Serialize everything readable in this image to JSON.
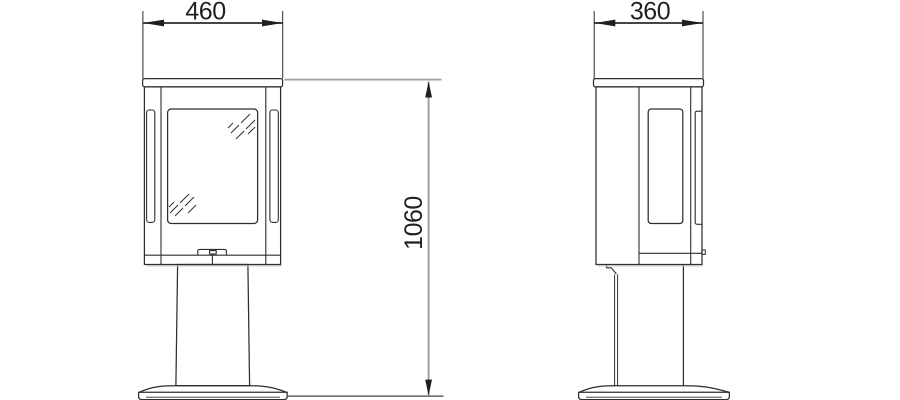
{
  "drawing": {
    "dimension_labels": {
      "front_width": "460",
      "side_width": "360",
      "height": "1060"
    },
    "colors": {
      "background": "#ffffff",
      "outline": "#2e2e2e",
      "dimension_dark": "#2b2b2b",
      "dimension_gray": "#9da0a3",
      "extension_bottom_gray": "#6e6e6e",
      "text": "#231f20",
      "shadow": "#c8c8c8"
    }
  }
}
